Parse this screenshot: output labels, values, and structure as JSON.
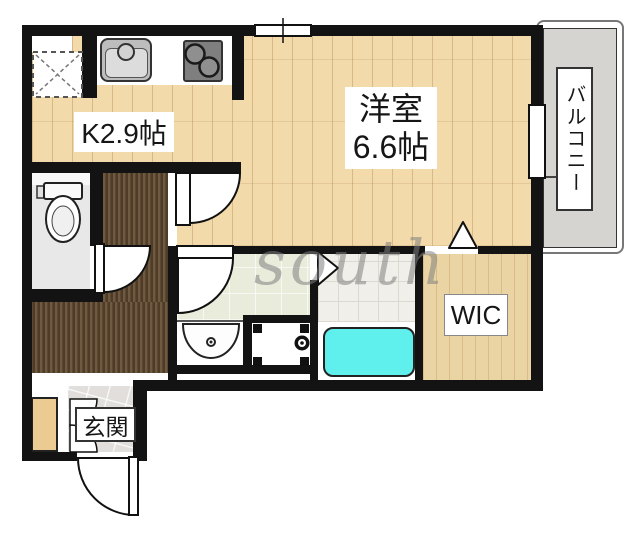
{
  "floorplan": {
    "labels": {
      "kitchen": "K2.9帖",
      "western_room_line1": "洋室",
      "western_room_line2": "6.6帖",
      "balcony": "バルコニー",
      "wic": "WIC",
      "entrance": "玄関"
    },
    "watermark": "south",
    "rooms": [
      {
        "name": "kitchen",
        "label": "K2.9帖"
      },
      {
        "name": "western-room",
        "label": "洋室6.6帖"
      },
      {
        "name": "balcony",
        "label": "バルコニー"
      },
      {
        "name": "walk-in-closet",
        "label": "WIC"
      },
      {
        "name": "entrance",
        "label": "玄関"
      }
    ],
    "colors": {
      "wall": "#131313",
      "wood_floor": "#f3daab",
      "wic_wood": "#ebd4a4",
      "carpet": "#5b4830",
      "bathtub": "#5ff0ee",
      "washroom_floor": "#e9ecda",
      "balcony_floor": "#d6d4d0",
      "entrance_tile": "#e1dedb",
      "toilet_floor": "#e8e8e8"
    }
  }
}
